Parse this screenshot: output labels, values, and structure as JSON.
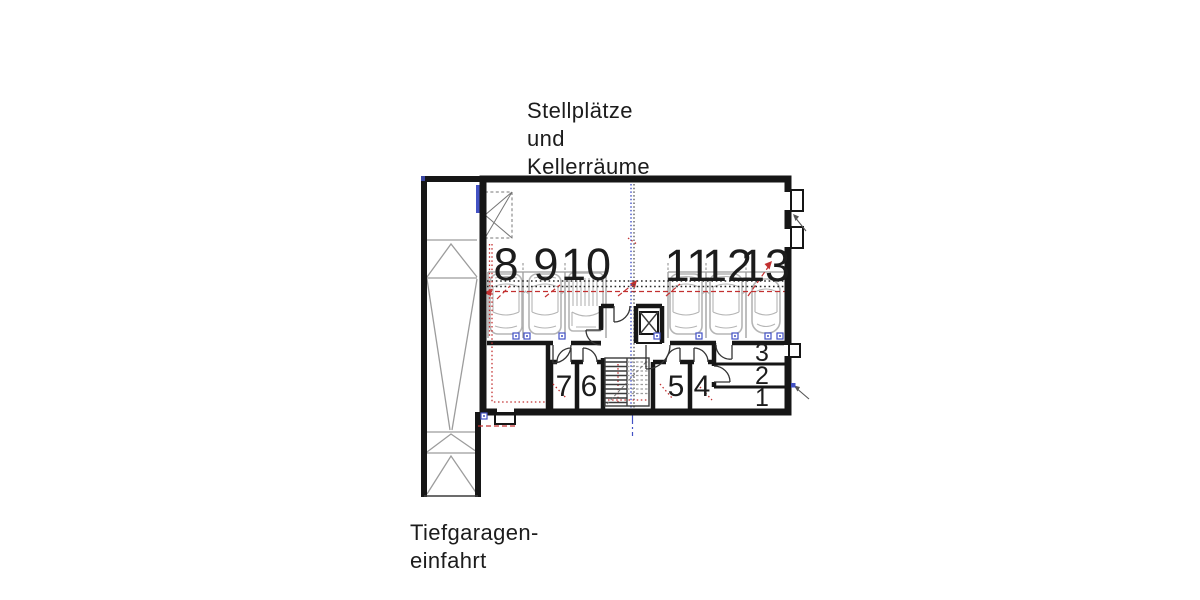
{
  "plan": {
    "heading": {
      "line1": "Stellplätze",
      "line2": "und",
      "line3": "Kellerräume"
    },
    "entrance_label": {
      "line1": "Tiefgaragen-",
      "line2": "einfahrt"
    },
    "parking_spaces": {
      "s8": "8",
      "s9": "9",
      "s10": "10",
      "s11": "11",
      "s12": "12",
      "s13": "13"
    },
    "cellar_rooms": {
      "r1": "1",
      "r2": "2",
      "r3": "3",
      "r4": "4",
      "r5": "5",
      "r6": "6",
      "r7": "7"
    },
    "icons": {
      "ramp_direction": "chevron-up-arrows",
      "elevator": "x-box",
      "door_swings": "quarter-arcs"
    },
    "colors": {
      "wall": "#161616",
      "drawing_gray": "#9c9c9c",
      "car_gray": "#b5b5b5",
      "utility_red": "#c23030",
      "utility_blue": "#4352c4",
      "label_text": "#1c1c1c",
      "background": "#ffffff"
    }
  }
}
